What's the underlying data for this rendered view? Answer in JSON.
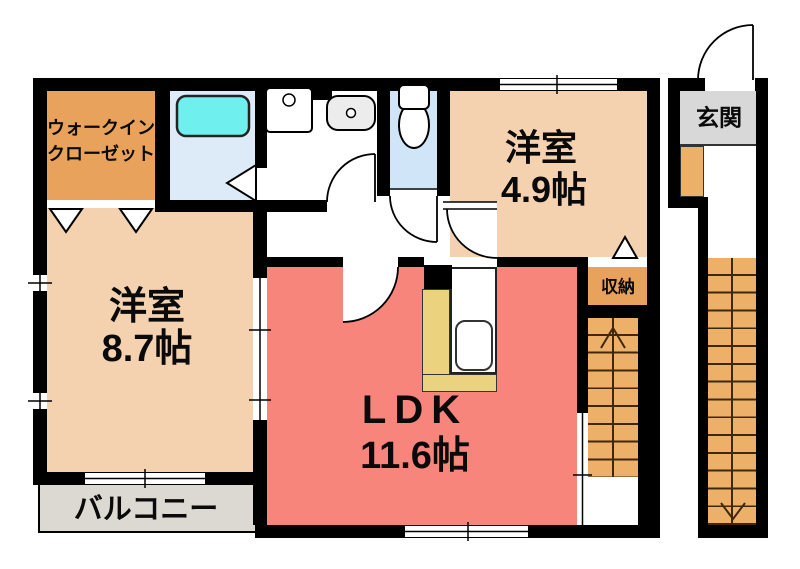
{
  "rooms": {
    "walk_in_closet": {
      "line1": "ウォークイン",
      "line2": "クローゼット"
    },
    "bedroom_left": {
      "type": "洋室",
      "size": "8.7帖"
    },
    "bedroom_right": {
      "type": "洋室",
      "size": "4.9帖"
    },
    "ldk": {
      "type": "LDK",
      "size": "11.6帖"
    },
    "storage": {
      "label": "収納"
    },
    "entrance": {
      "label": "玄関"
    },
    "balcony": {
      "label": "バルコニー"
    }
  },
  "colors": {
    "wall_black": "#000000",
    "room_peach": "#f4d2b0",
    "ldk_red": "#f8857c",
    "accent_orange": "#e9a25b",
    "stair_orange": "#edb069",
    "bath_blue": "#dcebf7",
    "toilet_blue": "#d0e5f8",
    "bathtub_cyan": "#6ff0ee",
    "kitchen_khaki": "#ead27f",
    "balcony_gray": "#dcd8d2",
    "entrance_gray": "#d8d8d8"
  }
}
